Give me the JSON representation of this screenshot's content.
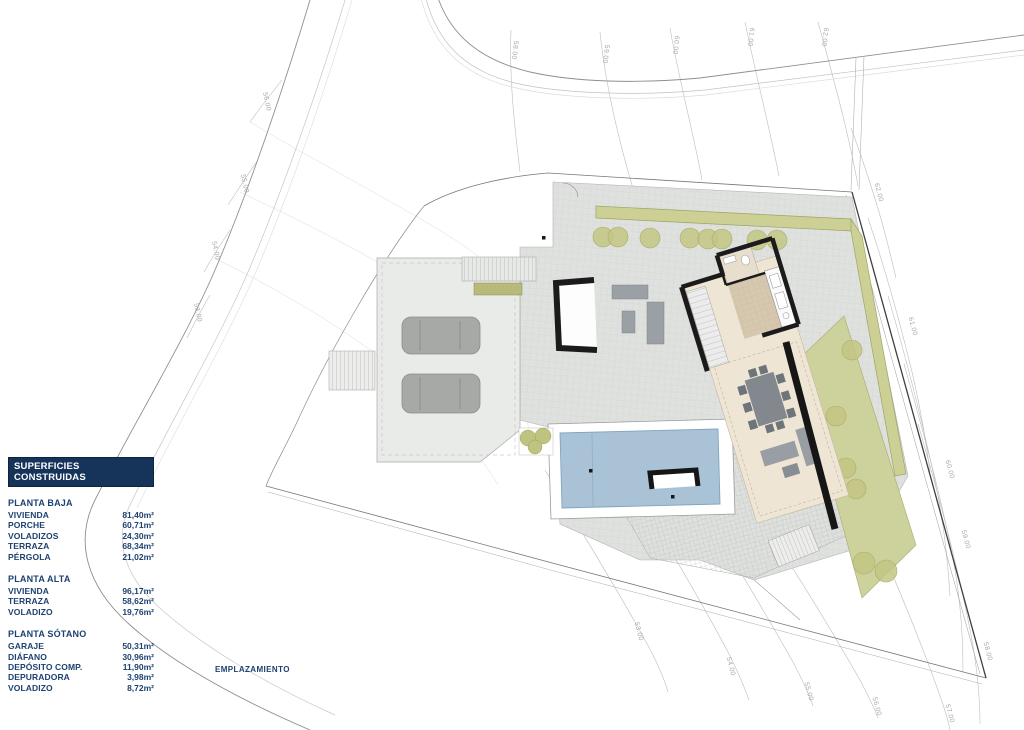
{
  "legend": {
    "title": "SUPERFICIES CONSTRUIDAS",
    "sections": [
      {
        "heading": "PLANTA BAJA",
        "rows": [
          {
            "label": "VIVIENDA",
            "value": "81,40m²"
          },
          {
            "label": "PORCHE",
            "value": "60,71m²"
          },
          {
            "label": "VOLADIZOS",
            "value": "24,30m²"
          },
          {
            "label": "TERRAZA",
            "value": "68,34m²"
          },
          {
            "label": "PÉRGOLA",
            "value": "21,02m²"
          }
        ]
      },
      {
        "heading": "PLANTA ALTA",
        "rows": [
          {
            "label": "VIVIENDA",
            "value": "96,17m²"
          },
          {
            "label": "TERRAZA",
            "value": "58,62m²"
          },
          {
            "label": "VOLADIZO",
            "value": "19,76m²"
          }
        ]
      },
      {
        "heading": "PLANTA SÓTANO",
        "rows": [
          {
            "label": "GARAJE",
            "value": "50,31m²"
          },
          {
            "label": "DIÁFANO",
            "value": "30,96m²"
          },
          {
            "label": "DEPÓSITO COMP.",
            "value": "11,90m²"
          },
          {
            "label": "DEPURADORA",
            "value": "3,98m²"
          },
          {
            "label": "VOLADIZO",
            "value": "8,72m²"
          }
        ]
      }
    ]
  },
  "caption": {
    "text": "EMPLAZAMIENTO"
  },
  "plan": {
    "contour_labels": [
      {
        "t": "58.00",
        "x": 513,
        "y": 50,
        "r": 97
      },
      {
        "t": "59.00",
        "x": 604,
        "y": 54,
        "r": 97
      },
      {
        "t": "60.00",
        "x": 674,
        "y": 45,
        "r": 97
      },
      {
        "t": "61.00",
        "x": 749,
        "y": 37,
        "r": 97
      },
      {
        "t": "62.00",
        "x": 823,
        "y": 37,
        "r": 97
      },
      {
        "t": "56.00",
        "x": 265,
        "y": 102,
        "r": 78
      },
      {
        "t": "55.00",
        "x": 243,
        "y": 184,
        "r": 78
      },
      {
        "t": "54.00",
        "x": 214,
        "y": 251,
        "r": 78
      },
      {
        "t": "53.00",
        "x": 196,
        "y": 313,
        "r": 78
      },
      {
        "t": "62.00",
        "x": 877,
        "y": 193,
        "r": 75
      },
      {
        "t": "61.00",
        "x": 911,
        "y": 327,
        "r": 75
      },
      {
        "t": "60.00",
        "x": 948,
        "y": 470,
        "r": 75
      },
      {
        "t": "59.00",
        "x": 964,
        "y": 540,
        "r": 75
      },
      {
        "t": "58.00",
        "x": 986,
        "y": 652,
        "r": 75
      },
      {
        "t": "57.00",
        "x": 948,
        "y": 714,
        "r": 75
      },
      {
        "t": "53.00",
        "x": 637,
        "y": 632,
        "r": 75
      },
      {
        "t": "54.00",
        "x": 729,
        "y": 667,
        "r": 75
      },
      {
        "t": "55.00",
        "x": 807,
        "y": 692,
        "r": 75
      },
      {
        "t": "56.00",
        "x": 875,
        "y": 707,
        "r": 75
      }
    ],
    "colors": {
      "contour": "#bdbdbd",
      "contour_dark": "#9a9a9a",
      "boundary": "#6f6f6f",
      "terrace": "#dfe1df",
      "driveway": "#e9ebe9",
      "hedge": "#ccd095",
      "lawn": "#cdd19c",
      "tree": "#c3c684",
      "pool": "#a9c2d6",
      "house_floor": "#eee5d4",
      "kitchen_floor": "#d6c7af",
      "wall": "#1b1b1b",
      "furniture": "#9aa0a4",
      "label_text": "#a8a8a8"
    }
  }
}
